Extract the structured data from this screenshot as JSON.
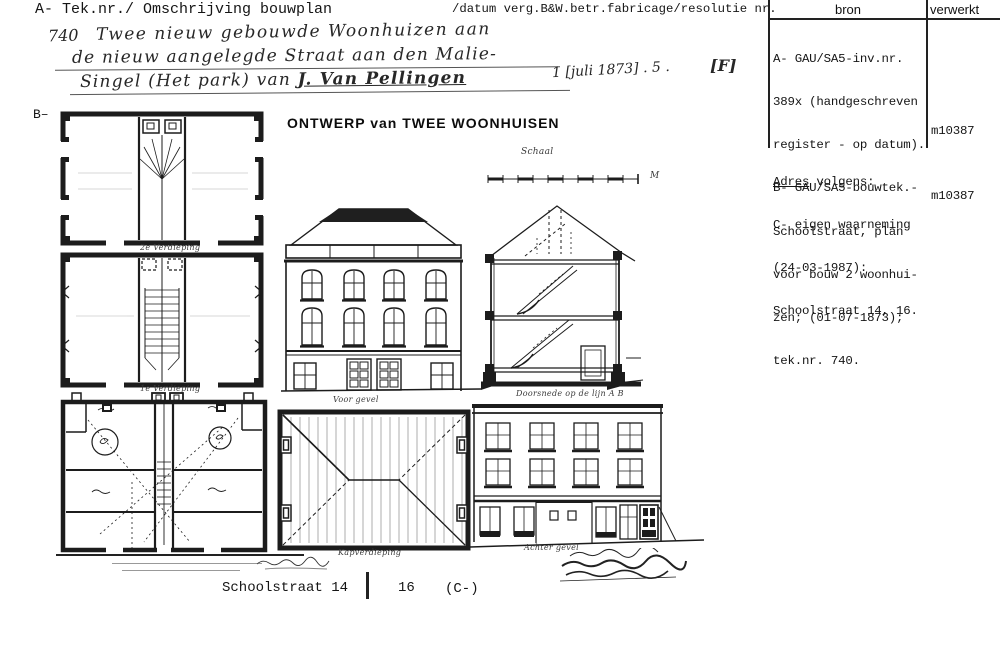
{
  "header": {
    "left": "A- Tek.nr./ Omschrijving bouwplan",
    "right": "/datum verg.B&W.betr.fabricage/resolutie nr.",
    "margin_label": "B–"
  },
  "bron_table": {
    "col_bron": "bron",
    "col_verwerkt": "verwerkt",
    "entry_a_lines": [
      "A- GAU/SA5-inv.nr.",
      "389x (handgeschreven",
      "register - op datum).",
      "B- GAU/SA5-bouwtek.-",
      "Schoolstraat, plan",
      "voor bouw 2 woonhui-",
      "zen; (01-07-1873);",
      "tek.nr. 740."
    ],
    "verwerkt_a": "m10387",
    "adres_label": "Adres",
    "adres_rest": " volgens:",
    "adres_lines": [
      "C- eigen waarneming",
      "(24-03-1987):",
      "Schoolstraat 14, 16."
    ],
    "verwerkt_b": "m10387"
  },
  "handwritten": {
    "number": "740",
    "line1": "Twee nieuw gebouwde Woonhuizen aan",
    "line2": "de nieuw aangelegde Straat aan den Malie-",
    "line3_pre": "Singel (Het park) van ",
    "line3_name": "J. Van Pellingen",
    "date": "1 [juli 1873] . 5 .",
    "mark": "[F]"
  },
  "drawing": {
    "title": "ONTWERP van TWEE WOONHUISEN",
    "schaal_label": "Schaal",
    "scale_unit": "M",
    "plan_top_label": "2e Verdieping",
    "plan_mid_label": "1e Verdieping",
    "facade_label": "Voor gevel",
    "roof_label": "Kapverdieping",
    "section_label": "Doorsnede op de lijn A B",
    "rear_label": "Achter gevel"
  },
  "footer": {
    "address_left": "Schoolstraat 14",
    "address_right": "16",
    "suffix": "(C-)"
  }
}
